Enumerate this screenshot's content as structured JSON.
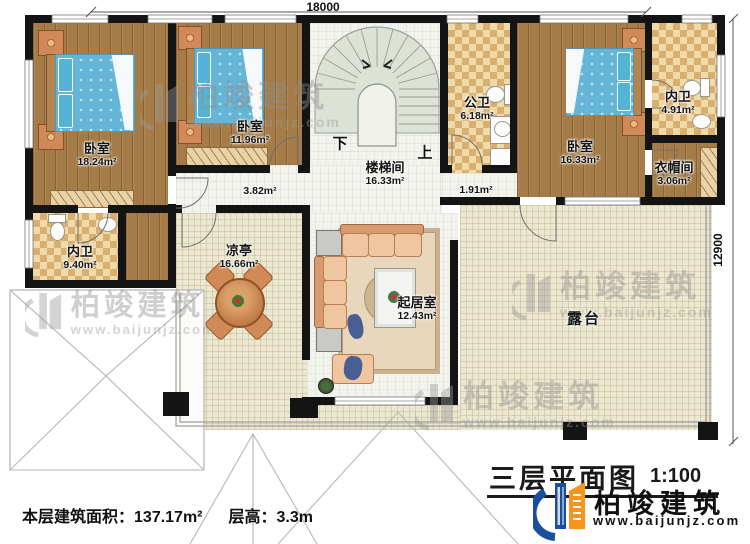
{
  "rooms": {
    "bedroom1": {
      "name": "卧室",
      "area": "18.24m²"
    },
    "bedroom2": {
      "name": "卧室",
      "area": "11.96m²"
    },
    "bedroom3": {
      "name": "卧室",
      "area": "16.33m²"
    },
    "stairwell": {
      "name": "楼梯间",
      "area": "16.33m²"
    },
    "public_bath": {
      "name": "公卫",
      "area": "6.18m²"
    },
    "ensuite_right": {
      "name": "内卫",
      "area": "4.91m²"
    },
    "cloakroom": {
      "name": "衣帽间",
      "area": "3.06m²"
    },
    "ensuite_left": {
      "name": "内卫",
      "area": "9.40m²"
    },
    "hallway_left": {
      "area": "3.82m²"
    },
    "hallway_right": {
      "area": "1.91m²"
    },
    "pavilion": {
      "name": "凉亭",
      "area": "16.66m²"
    },
    "living_room": {
      "name": "起居室",
      "area": "12.43m²"
    },
    "terrace": {
      "name": "露台"
    }
  },
  "stairs": {
    "down": "下",
    "up": "上"
  },
  "dimensions": {
    "width": "18000",
    "height": "12900"
  },
  "footer": {
    "floor_area_label": "本层建筑面积：",
    "floor_area_value": "137.17m²",
    "floor_height_label": "层高：",
    "floor_height_value": "3.3m"
  },
  "title_block": {
    "plan_title": "三层平面图",
    "scale": "1:100",
    "brand": "柏竣建筑",
    "website": "www.baijunjz.com"
  },
  "watermark": {
    "brand": "柏竣建筑",
    "website": "www.baijunjz.com"
  },
  "colors": {
    "wall": "#141414",
    "wood_floor": "#a57c48",
    "tile_floor": "#efdaaa",
    "terrace_floor": "#ece7d1",
    "stair_fill": "#dde3d8",
    "bed": "#65b6d6",
    "logo_blue": "#1b4f9c",
    "logo_orange": "#f7941d"
  }
}
